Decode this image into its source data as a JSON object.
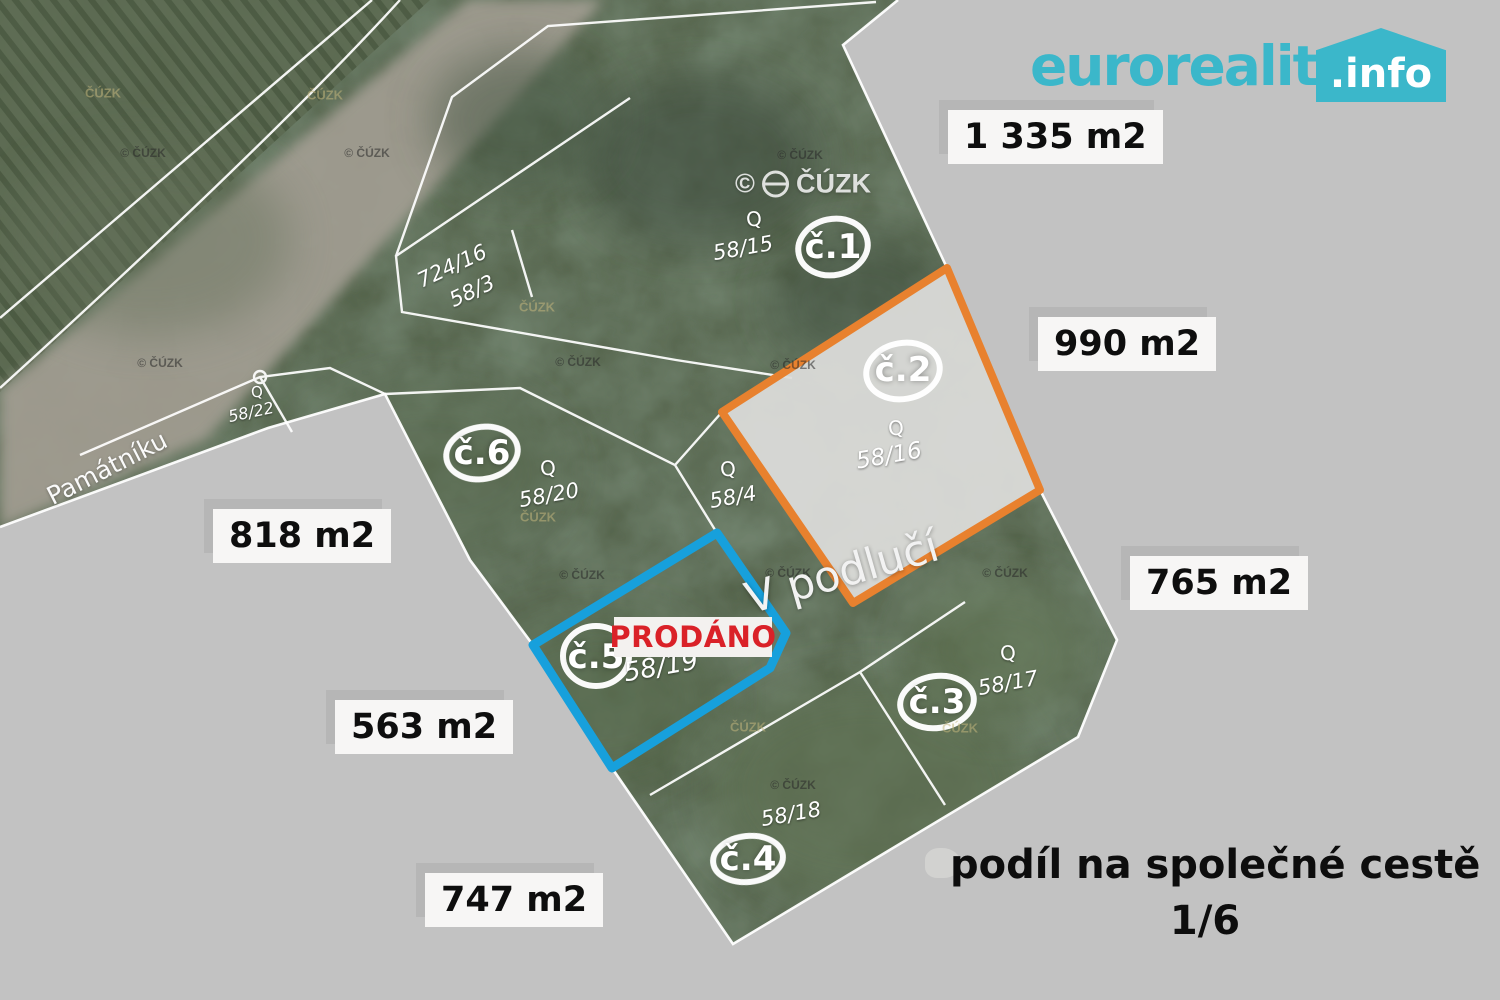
{
  "logo": {
    "brand": "euroreality",
    "suffix": ".info"
  },
  "share_note": {
    "line1": "podíl na společné cestě",
    "line2": "1/6"
  },
  "map": {
    "place_label": "V podlučí",
    "street_label": "Památníku",
    "sold_label": "PRODÁNO",
    "culture_symbol": "Q",
    "watermark_large_prefix": "©",
    "watermark_large_text": "ČÚZK",
    "watermark_small": "© ČÚZK",
    "watermark_plain": "ČÚZK"
  },
  "plots": [
    {
      "id": "č.1",
      "parcel": "58/15",
      "area": "1 335 m2"
    },
    {
      "id": "č.2",
      "parcel": "58/16",
      "area": "990 m2"
    },
    {
      "id": "č.3",
      "parcel": "58/17",
      "area": "765 m2"
    },
    {
      "id": "č.4",
      "parcel": "58/18",
      "area": "747 m2"
    },
    {
      "id": "č.5",
      "parcel": "58/19",
      "area": "563 m2"
    },
    {
      "id": "č.6",
      "parcel": "58/20",
      "area": "818 m2"
    }
  ],
  "adjacent_parcels": {
    "p724_16": "724/16",
    "p58_3": "58/3",
    "p58_22": "58/22",
    "p58_4": "58/4"
  },
  "colors": {
    "plot2_outline": "#E8812E",
    "plot5_outline": "#17A0DC",
    "brand": "#3BB7CA",
    "sold_text": "#DA2128",
    "canvas": "#C2C2C2"
  }
}
